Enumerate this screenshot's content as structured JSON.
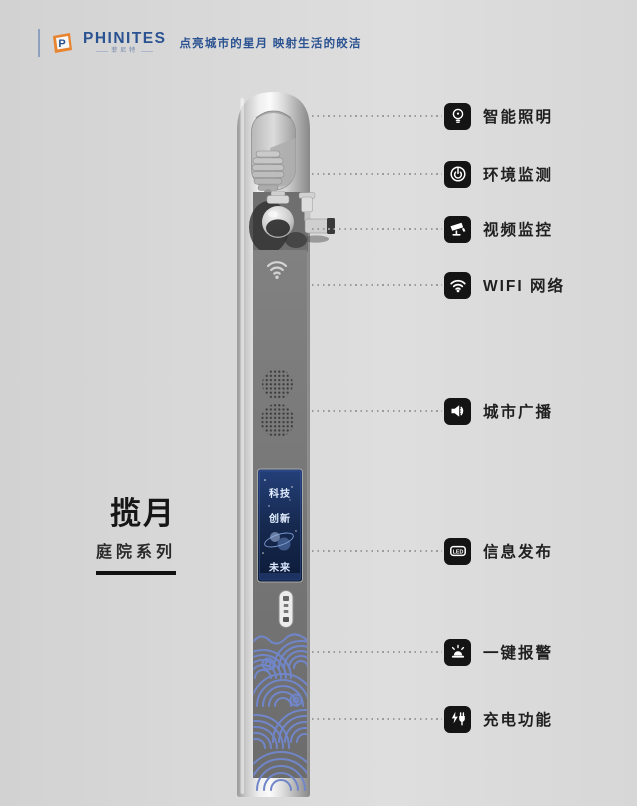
{
  "brand": {
    "logo_text": "PHINITES",
    "logo_subtext": "菲尼特",
    "tagline": "点亮城市的星月 映射生活的皎洁"
  },
  "product": {
    "title": "揽月",
    "series": "庭院系列"
  },
  "pole": {
    "screen": {
      "line1": "科技",
      "line2": "创新",
      "line3": "未来"
    }
  },
  "features": [
    {
      "label": "智能照明",
      "icon": "lightbulb-icon"
    },
    {
      "label": "环境监测",
      "icon": "environment-monitor-icon"
    },
    {
      "label": "视频监控",
      "icon": "cctv-camera-icon"
    },
    {
      "label": "WIFI 网络",
      "icon": "wifi-icon"
    },
    {
      "label": "城市广播",
      "icon": "speaker-icon"
    },
    {
      "label": "信息发布",
      "icon": "led-screen-icon",
      "icon_text": "LED"
    },
    {
      "label": "一键报警",
      "icon": "alarm-icon"
    },
    {
      "label": "充电功能",
      "icon": "charging-icon"
    }
  ],
  "colors": {
    "background": "#d8d8d8",
    "brand_blue": "#2b5291",
    "logo_orange": "#e8832f",
    "icon_tile_black": "#141414",
    "pole_face_gray": "#787878",
    "screen_blue": "#16294f",
    "wave_blue": "#7186c9",
    "label_black": "#1f1f1f"
  }
}
